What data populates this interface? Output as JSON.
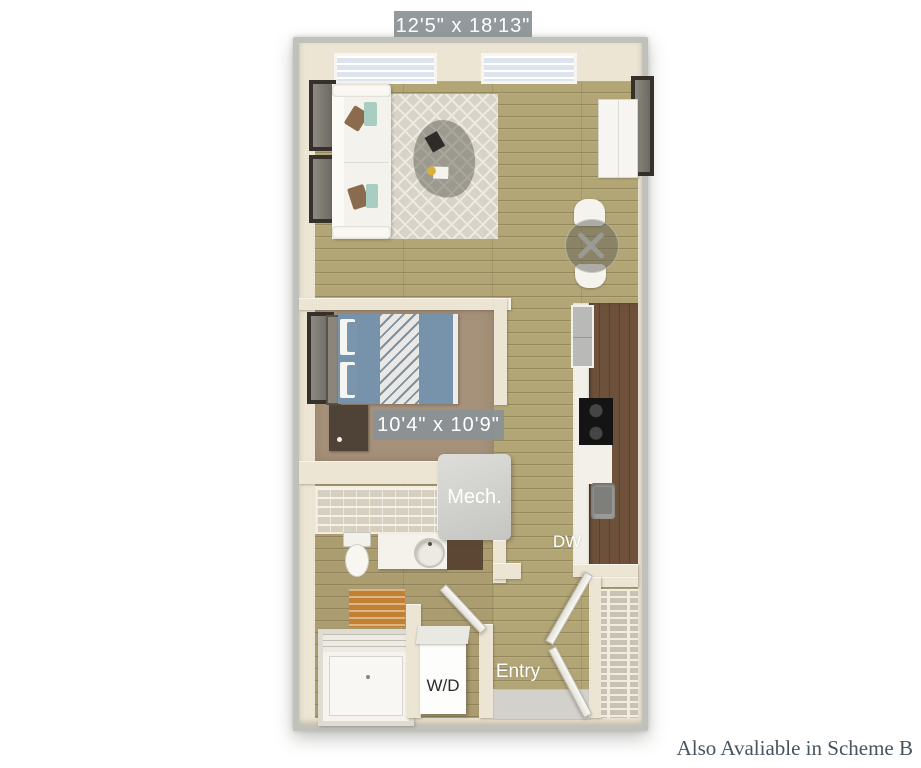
{
  "floorplan": {
    "overall_dimensions": "12'5\" x 18'13\"",
    "room_dimensions": "10'4\" x 10'9\"",
    "labels": {
      "mech": "Mech.",
      "dishwasher": "DW",
      "washer_dryer": "W/D",
      "entry": "Entry"
    },
    "footnote": "Also Avaliable in Scheme B",
    "colors": {
      "badge_background": "#8a9196",
      "badge_text": "#ffffff",
      "wall_cream": "#ece5d3",
      "wall_outer_gray": "#c1c1bb",
      "floor_wood": "#b3a676",
      "bedroom_carpet": "#a6917a",
      "kitchen_counter_brown": "#6e513b",
      "bed_blue": "#7792ab",
      "rug_beige": "#d8d3c9",
      "bath_mat_orange": "#c08134",
      "footnote_text": "#47545f"
    }
  }
}
